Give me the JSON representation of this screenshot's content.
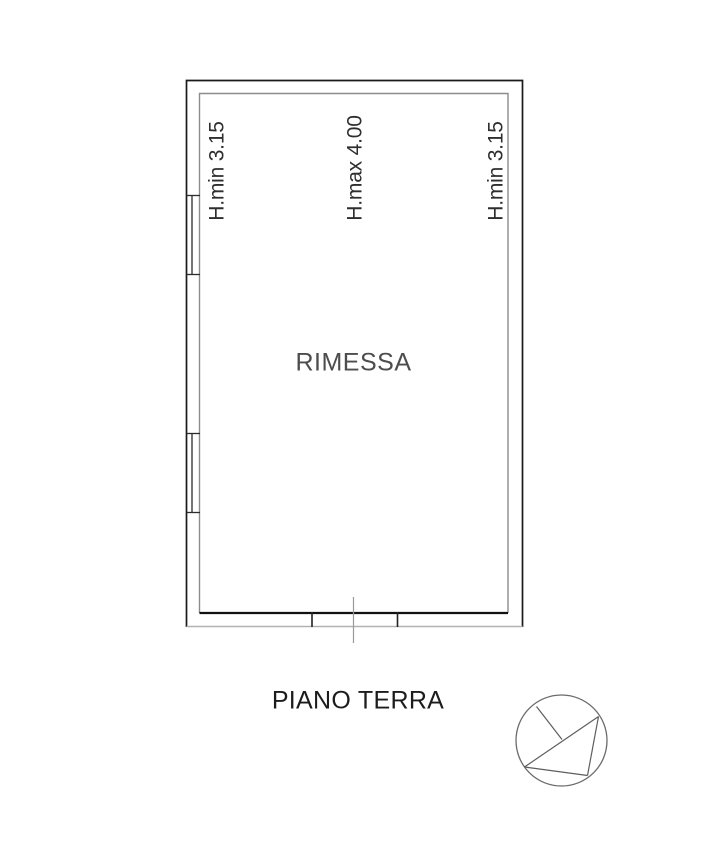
{
  "drawing": {
    "type": "floor-plan",
    "room_label": "RIMESSA",
    "caption": "PIANO TERRA",
    "height_labels": [
      {
        "position": "left",
        "text": "H.min 3.15"
      },
      {
        "position": "center",
        "text": "H.max 4.00"
      },
      {
        "position": "right",
        "text": "H.min 3.15"
      }
    ],
    "symbols": [
      {
        "name": "north-arrow-icon",
        "description": "circle with arrow needle, bottom right"
      },
      {
        "name": "window-symbol",
        "count": 2,
        "wall": "left"
      },
      {
        "name": "garage-door-opening",
        "wall": "bottom"
      }
    ],
    "colors": {
      "background": "#ffffff",
      "outer_wall": "#1a1a1a",
      "inner_wall": "#8c8c8c",
      "inner_wall_bottom": "#111111",
      "outer_wall_bottom": "#b3b3b3",
      "window_lines": "#2b2b2b",
      "section_line": "#9a9a9a",
      "north_symbol": "#5e5e5e",
      "room_text": "#4d4d4d",
      "caption_text": "#1c1c1c",
      "height_text": "#2e2e2e"
    }
  }
}
